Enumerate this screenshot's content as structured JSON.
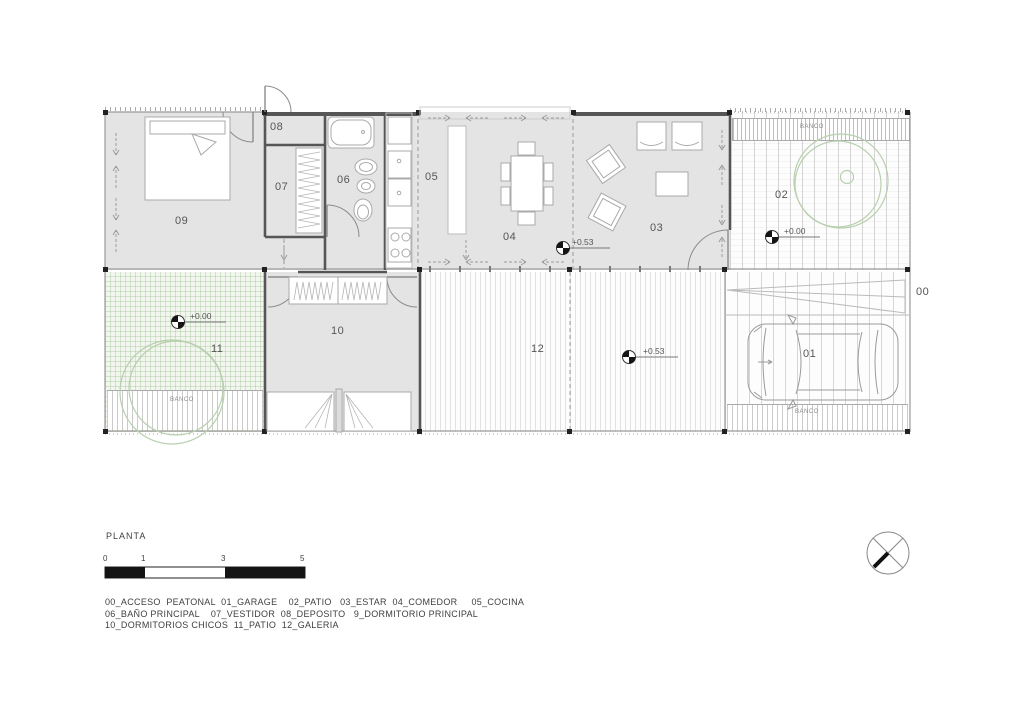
{
  "page": {
    "title": "PLANTA"
  },
  "rooms": {
    "r00": "00",
    "r01": "01",
    "r02": "02",
    "r03": "03",
    "r04": "04",
    "r05": "05",
    "r06": "06",
    "r07": "07",
    "r08": "08",
    "r09": "09",
    "r10": "10",
    "r11": "11",
    "r12": "12"
  },
  "annotations": {
    "banco": "BANCO",
    "level_estar": "+0.53",
    "level_galeria": "+0.53",
    "level_patio2": "+0.00",
    "level_patio11": "+0.00"
  },
  "scale_bar": {
    "ticks": [
      "0",
      "1",
      "3",
      "5"
    ]
  },
  "legend": {
    "lines": [
      "00_ACCESO  PEATONAL  01_GARAGE    02_PATIO   03_ESTAR  04_COMEDOR     05_COCINA",
      "06_BAÑO PRINCIPAL    07_VESTIDOR  08_DEPOSITO   9_DORMITORIO PRINCIPAL",
      "10_DORMITORIOS CHICOS  11_PATIO  12_GALERIA"
    ]
  },
  "colors": {
    "wall": "#555555",
    "room_fill": "#e4e4e4",
    "tree_green": "#b8cfae",
    "text": "#4a4a4a"
  }
}
